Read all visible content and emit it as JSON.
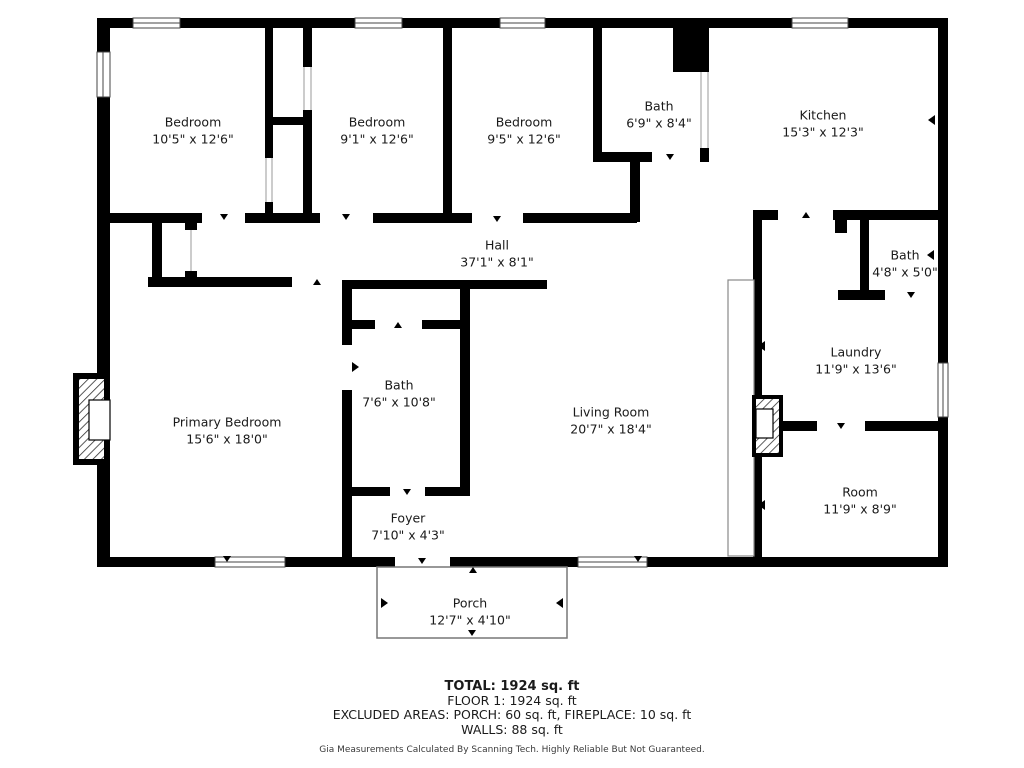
{
  "rooms": {
    "bedroom1": {
      "name": "Bedroom",
      "dims": "10'5\" x 12'6\""
    },
    "bedroom2": {
      "name": "Bedroom",
      "dims": "9'1\" x 12'6\""
    },
    "bedroom3": {
      "name": "Bedroom",
      "dims": "9'5\" x 12'6\""
    },
    "bathTop": {
      "name": "Bath",
      "dims": "6'9\" x 8'4\""
    },
    "kitchen": {
      "name": "Kitchen",
      "dims": "15'3\" x 12'3\""
    },
    "hall": {
      "name": "Hall",
      "dims": "37'1\" x 8'1\""
    },
    "bathRight": {
      "name": "Bath",
      "dims": "4'8\" x 5'0\""
    },
    "laundry": {
      "name": "Laundry",
      "dims": "11'9\" x 13'6\""
    },
    "room": {
      "name": "Room",
      "dims": "11'9\" x 8'9\""
    },
    "livingRoom": {
      "name": "Living Room",
      "dims": "20'7\" x 18'4\""
    },
    "primaryBedroom": {
      "name": "Primary Bedroom",
      "dims": "15'6\" x 18'0\""
    },
    "bathMiddle": {
      "name": "Bath",
      "dims": "7'6\" x 10'8\""
    },
    "foyer": {
      "name": "Foyer",
      "dims": "7'10\" x 4'3\""
    },
    "porch": {
      "name": "Porch",
      "dims": "12'7\" x 4'10\""
    }
  },
  "summary": {
    "total": "TOTAL: 1924 sq. ft",
    "floor": "FLOOR 1: 1924 sq. ft",
    "excluded": "EXCLUDED AREAS: PORCH: 60 sq. ft, FIREPLACE: 10 sq. ft",
    "walls": "WALLS: 88 sq. ft",
    "disclaimer": "Gia Measurements Calculated By Scanning Tech. Highly Reliable But Not Guaranteed."
  },
  "colors": {
    "wall": "#000000",
    "background": "#ffffff",
    "porch_outline": "#777777",
    "window_line": "#444444",
    "text": "#1a1a1a"
  }
}
